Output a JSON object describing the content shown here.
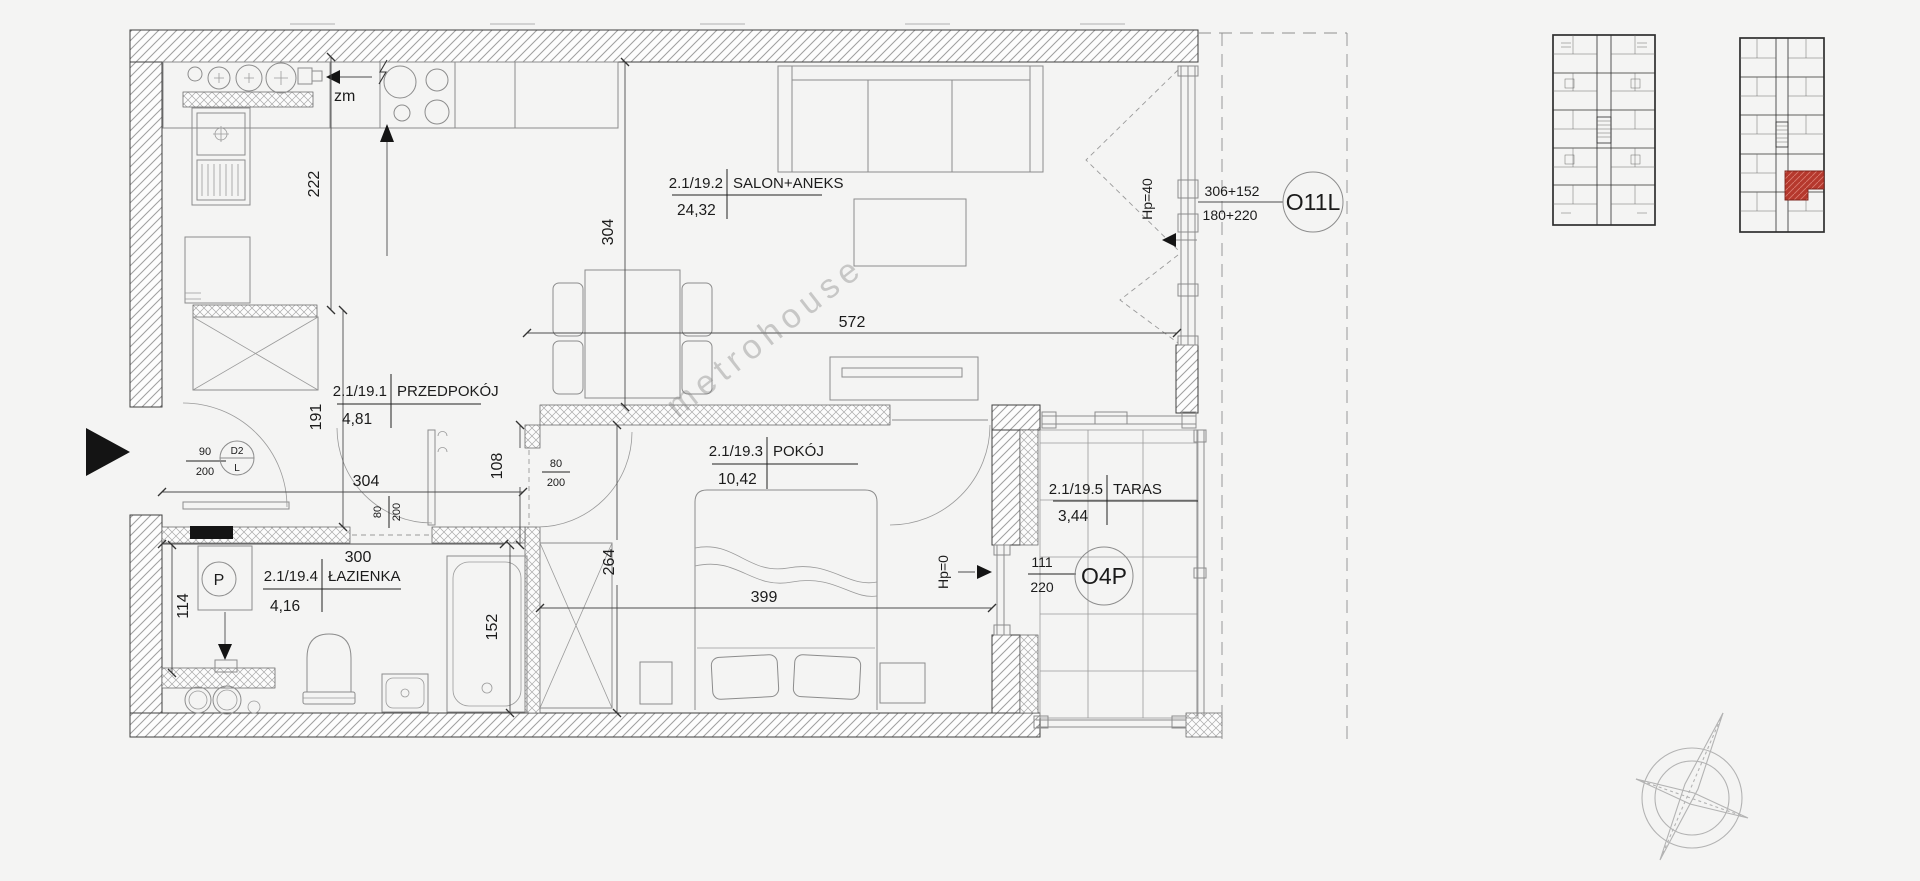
{
  "floorplan": {
    "watermark": "metrohouse",
    "rooms": [
      {
        "code": "2.1/19.1",
        "name": "PRZEDPOKÓJ",
        "area": "4,81"
      },
      {
        "code": "2.1/19.2",
        "name": "SALON+ANEKS",
        "area": "24,32"
      },
      {
        "code": "2.1/19.3",
        "name": "POKÓJ",
        "area": "10,42"
      },
      {
        "code": "2.1/19.4",
        "name": "ŁAZIENKA",
        "area": "4,16"
      },
      {
        "code": "2.1/19.5",
        "name": "TARAS",
        "area": "3,44"
      }
    ],
    "dims": {
      "kitchen_run": "222",
      "salon_depth": "304",
      "salon_width": "572",
      "hall_depth": "191",
      "hall_width": "304",
      "bath_width": "300",
      "niche": "108",
      "room_depth": "264",
      "room_width": "399",
      "tub": "152",
      "washer_bay": "114"
    },
    "doors": {
      "entry": {
        "width": "90",
        "height": "200",
        "code": "D2",
        "swing": "L"
      },
      "bath": {
        "width": "80",
        "height": "200"
      },
      "room": {
        "width": "80",
        "height": "200"
      }
    },
    "windows": {
      "salon": {
        "code": "O11L",
        "glazing_upper": "306+152",
        "glazing_lower": "180+220",
        "parapet": "Hp=40"
      },
      "terrace": {
        "code": "O4P",
        "width": "111",
        "height": "220",
        "parapet": "Hp=0"
      }
    },
    "annotations": {
      "dishwasher": "zm",
      "washing_machine": "P"
    }
  },
  "colors": {
    "background": "#f4f4f3",
    "line": "#3f3f3f",
    "highlight_unit": "#b5382d"
  }
}
